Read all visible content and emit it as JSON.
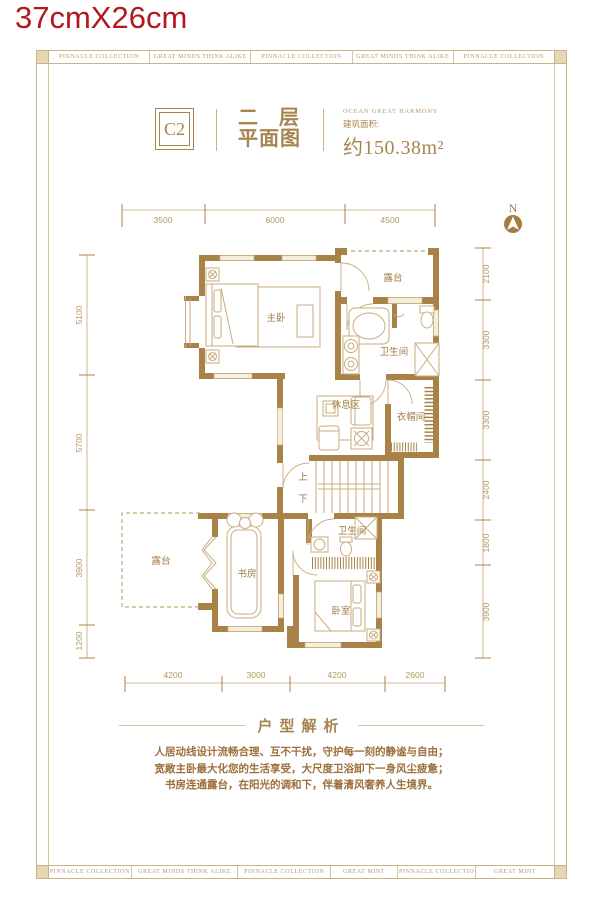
{
  "meta": {
    "size_label": "37cmX26cm"
  },
  "palette": {
    "red": "#b1191f",
    "gold": "#a8854e",
    "wall": "#a98248",
    "light_line": "#c9ad7e"
  },
  "border": {
    "top_cells": [
      "PINNACLE COLLECTION",
      "GREAT MINDS THINK ALIKE",
      "PINNACLE COLLECTION",
      "GREAT MINDS THINK ALIKE",
      "PINNACLE COLLECTION"
    ],
    "bottom_cells": [
      "PINNACLE COLLECTION",
      "GREAT MINDS THINK ALIKE",
      "PINNACLE COLLECTION",
      "GREAT MINT",
      "PINNACLE COLLECTIO",
      "GREAT MINT"
    ]
  },
  "header": {
    "unit_code": "C2",
    "title_line1": "二 层",
    "title_line2": "平面图",
    "project_en": "OCEAN GREAT HARMONY",
    "area_label": "建筑面积:",
    "area_value": "约150.38m²"
  },
  "compass": {
    "label": "N"
  },
  "plan": {
    "rooms": {
      "master_bedroom": "主卧",
      "terrace_top": "露台",
      "bath_top": "卫生间",
      "lounge": "休息区",
      "cloakroom": "衣帽间",
      "stairs_up": "上",
      "stairs_down": "下",
      "terrace_bottom": "露台",
      "study": "书房",
      "bath_bottom": "卫生间",
      "bedroom": "卧室"
    },
    "dims": {
      "top": [
        "3500",
        "6000",
        "4500"
      ],
      "bottom": [
        "4200",
        "3000",
        "4200",
        "2600"
      ],
      "left": [
        "5100",
        "5700",
        "3900",
        "1200"
      ],
      "right": [
        "2100",
        "3300",
        "3300",
        "2400",
        "1800",
        "3900"
      ]
    }
  },
  "analysis": {
    "heading": "户型解析",
    "lines": [
      "人居动线设计流畅合理、互不干扰，守护每一刻的静谧与自由；",
      "宽敞主卧最大化您的生活享受，大尺度卫浴卸下一身风尘疲惫；",
      "书房连通露台，在阳光的调和下，伴着清风奢养人生境界。"
    ]
  }
}
